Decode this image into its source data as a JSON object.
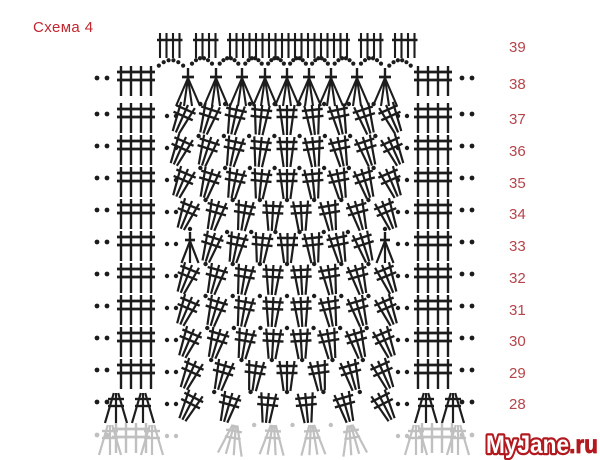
{
  "title": {
    "text": "Схема 4"
  },
  "watermark": {
    "main": "MyJane",
    "suffix": ".ru"
  },
  "colors": {
    "ink": "#1c1c1c",
    "faded": "#c0c0c0",
    "title": "#c2262e",
    "label": "#b5444b",
    "watermark_red": "#b2191f",
    "watermark_fill": "#ffffff",
    "background": "#ffffff"
  },
  "row_labels": [
    "39",
    "38",
    "37",
    "36",
    "35",
    "34",
    "33",
    "32",
    "31",
    "30",
    "29",
    "28"
  ],
  "chart": {
    "type": "crochet-stitch-chart",
    "label_x": 509,
    "left_grid_x": 136,
    "right_grid_x": 433,
    "edge_dots_left": [
      97,
      107
    ],
    "edge_dots_right": [
      462,
      472
    ],
    "mid_dots": [
      167,
      176,
      398,
      407
    ],
    "rows": [
      {
        "label": "39",
        "y": 33,
        "label_y": 52,
        "type": "combs",
        "combs": [
          {
            "x": 160,
            "ticks": 4
          },
          {
            "x": 196,
            "ticks": 4
          },
          {
            "x": 230,
            "ticks": 19
          },
          {
            "x": 361,
            "ticks": 4
          },
          {
            "x": 395,
            "ticks": 4
          }
        ]
      },
      {
        "label": "38",
        "y": 66,
        "label_y": 89,
        "type": "arch",
        "cluster_xs": [
          188,
          216,
          242,
          265,
          287,
          309,
          331,
          357,
          385
        ]
      },
      {
        "label": "37",
        "y": 103,
        "label_y": 124,
        "type": "fan",
        "groups": 9,
        "span": [
          188,
          386
        ],
        "lean": 24
      },
      {
        "label": "36",
        "y": 135,
        "label_y": 156,
        "type": "fan",
        "groups": 9,
        "span": [
          186,
          388
        ],
        "lean": 24
      },
      {
        "label": "35",
        "y": 167,
        "label_y": 188,
        "type": "fan",
        "groups": 9,
        "span": [
          188,
          386
        ],
        "lean": 23
      },
      {
        "label": "34",
        "y": 199,
        "label_y": 219,
        "type": "fan",
        "groups": 8,
        "span": [
          192,
          382
        ],
        "lean": 22
      },
      {
        "label": "33",
        "y": 231,
        "label_y": 251,
        "type": "fan",
        "groups": 7,
        "span": [
          215,
          360
        ],
        "lean": 18,
        "a_clusters": [
          190,
          385
        ]
      },
      {
        "label": "32",
        "y": 263,
        "label_y": 283,
        "type": "fan",
        "groups": 8,
        "span": [
          192,
          382
        ],
        "lean": 22
      },
      {
        "label": "31",
        "y": 295,
        "label_y": 315,
        "type": "fan",
        "groups": 8,
        "span": [
          192,
          382
        ],
        "lean": 23
      },
      {
        "label": "30",
        "y": 327,
        "label_y": 346,
        "type": "fan",
        "groups": 8,
        "span": [
          194,
          380
        ],
        "lean": 23
      },
      {
        "label": "29",
        "y": 359,
        "label_y": 378,
        "type": "fan",
        "groups": 7,
        "span": [
          196,
          378
        ],
        "lean": 24
      },
      {
        "label": "28",
        "y": 391,
        "label_y": 409,
        "type": "fan",
        "groups": 6,
        "span": [
          196,
          378
        ],
        "lean": 27,
        "no_grid": true,
        "edge_fans": [
          [
            116,
            143
          ],
          [
            426,
            453
          ]
        ]
      },
      {
        "label": "",
        "y": 423,
        "type": "faded",
        "groups": 4,
        "span": [
          235,
          350
        ],
        "lean": 10
      }
    ]
  }
}
